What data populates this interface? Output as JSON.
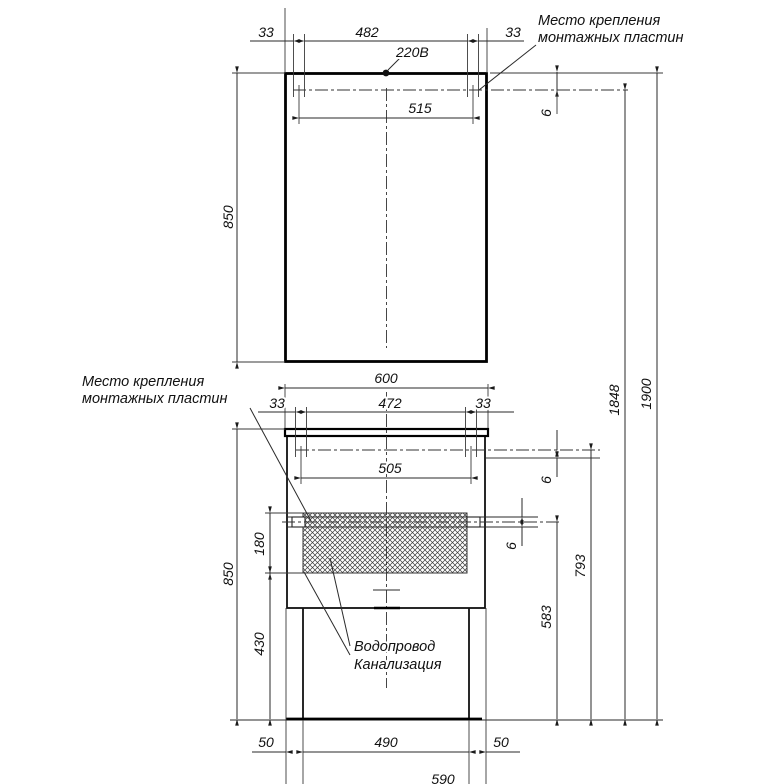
{
  "annotations": {
    "power": "220В",
    "mounting_plates_top": {
      "line1": "Место крепления",
      "line2": "монтажных пластин"
    },
    "mounting_plates_side": {
      "line1": "Место крепления",
      "line2": "монтажных пластин"
    },
    "plumbing": {
      "line1": "Водопровод",
      "line2": "Канализация"
    }
  },
  "dimensions": {
    "mirror": {
      "plate_left": "33",
      "plate_right": "33",
      "plates_inner": "482",
      "plates_centers": "515",
      "height": "850",
      "plate_offset": "6",
      "plate_line_from_floor": "1848",
      "top_from_floor": "1900"
    },
    "vanity": {
      "width": "600",
      "plate_left": "33",
      "plate_right": "33",
      "plates_inner": "472",
      "plates_centers": "505",
      "plate_offset": "6",
      "strip_offset": "6",
      "hatch_height": "180",
      "height": "850",
      "hatch_to_floor": "430",
      "strip_from_floor": "583",
      "plates_from_floor": "793"
    },
    "base": {
      "left": "50",
      "width": "490",
      "right": "50",
      "overall": "590"
    }
  },
  "colors": {
    "line": "#1a1a1a",
    "background": "#ffffff"
  }
}
